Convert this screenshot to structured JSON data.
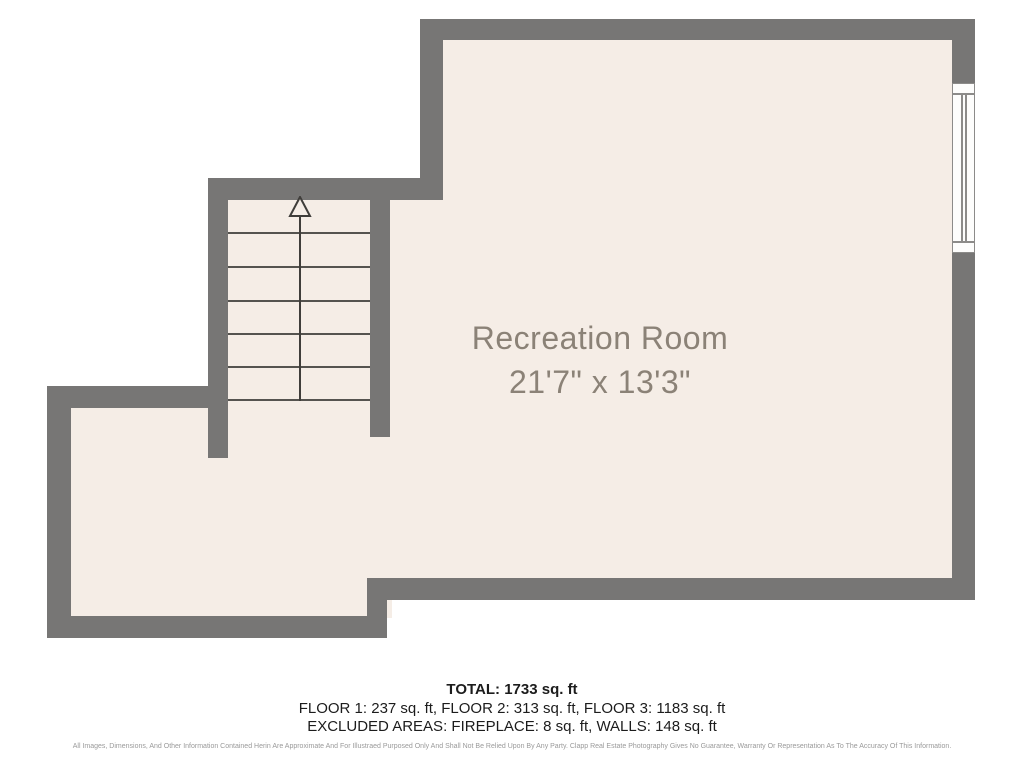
{
  "floor_plan": {
    "room": {
      "name": "Recreation Room",
      "dimensions": "21'7\" x 13'3\""
    },
    "stairs": {
      "direction": "up",
      "tread_lines": 6
    },
    "window_count": 1
  },
  "summary": {
    "total": "TOTAL: 1733 sq. ft",
    "floors": "FLOOR 1: 237 sq. ft, FLOOR 2: 313 sq. ft, FLOOR 3: 1183 sq. ft",
    "excluded": "EXCLUDED AREAS: FIREPLACE: 8 sq. ft, WALLS: 148 sq. ft"
  },
  "disclaimer": "All Images, Dimensions, And Other Information Contained Herin Are Approximate And For Illustraed Purposed Only And Shall Not Be Relied Upon By Any Party. Clapp Real Estate Photography Gives No Guarantee, Warranty Or Representation As To The Accuracy Of This Information.",
  "colors": {
    "wall": "#777675",
    "floor": "#f5ede6",
    "label_text": "#8b8277",
    "summary_text": "#1c1c1c"
  }
}
